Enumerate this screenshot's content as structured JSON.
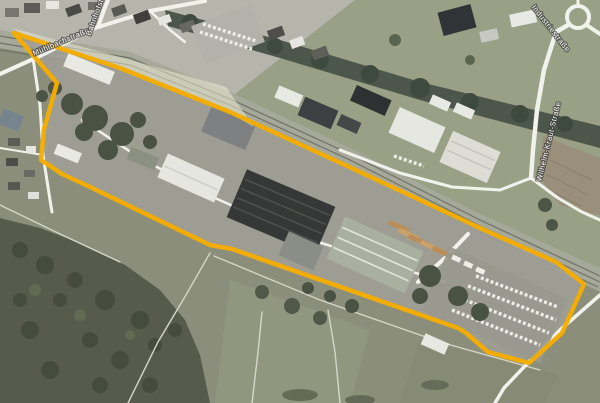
{
  "map": {
    "street_labels": [
      {
        "name": "Mühlbachstraße"
      },
      {
        "name": "Bahnhofstraße"
      },
      {
        "name": "Industriestraße"
      },
      {
        "name": "Wilhelm-Kraut-Straße"
      }
    ],
    "annotation": {
      "outline_color": "#F6AD00",
      "outline_width": "4.5",
      "polygon_points": "14,33 120,68 230,112 345,165 480,228 556,262 584,284 562,333 529,363 488,352 466,333 458,328 232,249 210,245 88,186 62,174 41,160 44,129 57,83",
      "railway_highlight_points": "12,28 120,57 226,87 254,127 228,112 120,67 32,40",
      "railway_highlight_color": "rgba(240,240,215,0.5)"
    }
  }
}
